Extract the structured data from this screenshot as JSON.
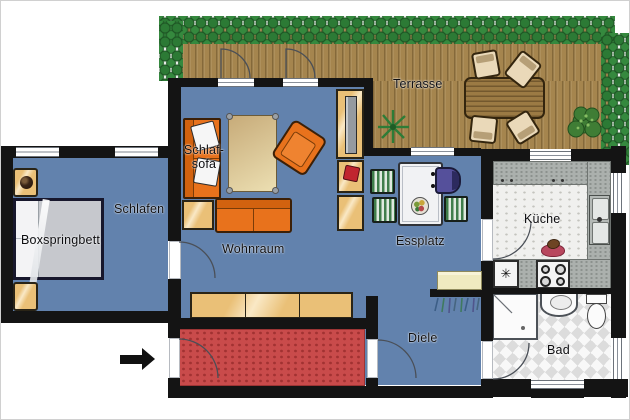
{
  "labels": {
    "terrasse": "Terrasse",
    "schlafen": "Schlafen",
    "wohnraum": "Wohnraum",
    "essplatz": "Essplatz",
    "kueche": "Küche",
    "bad": "Bad",
    "diele": "Diele",
    "boxspringbett": "Boxspringbett",
    "schlafsofa_line1": "Schlaf-",
    "schlafsofa_line2": "sofa"
  },
  "icons": {
    "freezer_symbol": "✳",
    "entrance_arrow": "right-arrow"
  },
  "colors": {
    "wall": "#141414",
    "floor_blue": "#6282ad",
    "deck_wood": "#a5854e",
    "hedge_green": "#2c7a35",
    "furniture_orange": "#e8721c",
    "furniture_wood": "#eac077",
    "carpet_red": "#c94b4b",
    "kitchen_counter": "#abb0ad",
    "chair_green": "#3f7d4a",
    "chair_purple": "#56519e",
    "dining_table": "#f1f2f4"
  }
}
